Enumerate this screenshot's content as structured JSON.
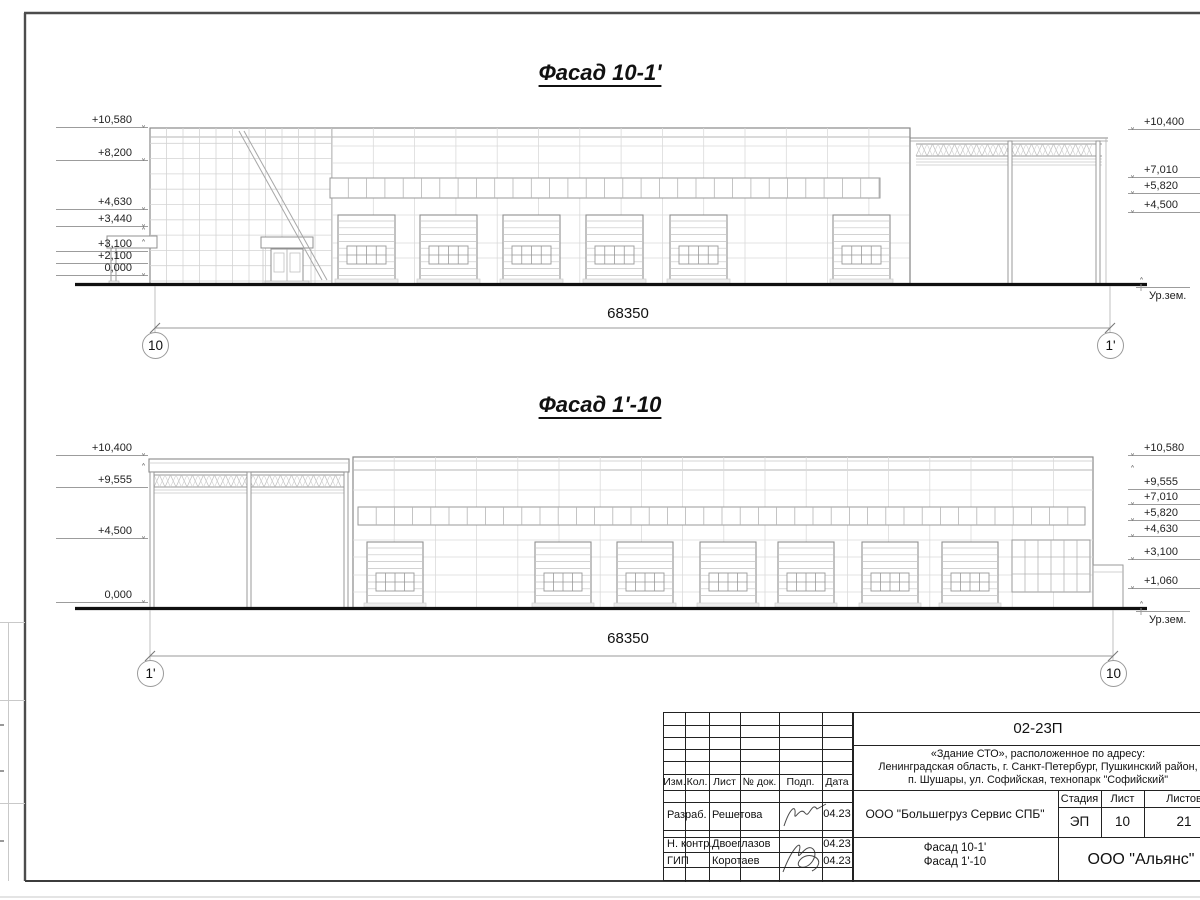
{
  "page": {
    "icons": {
      "elevation_down": "˅",
      "elevation_up": "˄"
    },
    "facade_top": {
      "title": "Фасад 10-1'",
      "dimension": "68350",
      "axis_left": "10",
      "axis_right": "1'",
      "ground_label": "Ур.зем.",
      "left_marks": [
        "+10,580",
        "+8,200",
        "+4,630",
        "+3,440",
        "+3,100",
        "+2,100",
        "0,000"
      ],
      "right_marks": [
        "+10,400",
        "+7,010",
        "+5,820",
        "+4,500"
      ]
    },
    "facade_bottom": {
      "title": "Фасад 1'-10",
      "dimension": "68350",
      "axis_left": "1'",
      "axis_right": "10",
      "ground_label": "Ур.зем.",
      "left_marks": [
        "+10,400",
        "+9,555",
        "+4,500",
        "0,000"
      ],
      "right_marks": [
        "+10,580",
        "+9,555",
        "+7,010",
        "+5,820",
        "+4,630",
        "+3,100",
        "+1,060"
      ]
    },
    "title_block": {
      "doc_number": "02-23П",
      "object_line1": "«Здание СТО», расположенное по адресу:",
      "object_line2": "Ленинградская область, г. Санкт-Петербург, Пушкинский район,",
      "object_line3": "п. Шушары, ул. Софийская, технопарк \"Софийский\"",
      "client": "ООО \"Большегруз Сервис СПБ\"",
      "drawing_title_line1": "Фасад 10-1'",
      "drawing_title_line2": "Фасад 1'-10",
      "company": "ООО \"Альянс\"",
      "col_izm": "Изм.",
      "col_kol": "Кол.",
      "col_list": "Лист",
      "col_doc": "№ док.",
      "col_podp": "Подп.",
      "col_data": "Дата",
      "stage_header": "Стадия",
      "sheet_header": "Лист",
      "sheets_header": "Листов",
      "stage": "ЭП",
      "sheet_num": "10",
      "sheets_total": "21",
      "row1_role": "Разраб.",
      "row1_name": "Решетова",
      "row1_date": "04.23",
      "row2_role": "Н. контр.",
      "row2_name": "Двоеглазов",
      "row2_date": "04.23",
      "row3_role": "ГИП",
      "row3_name": "Коротаев",
      "row3_date": "04.23"
    }
  }
}
